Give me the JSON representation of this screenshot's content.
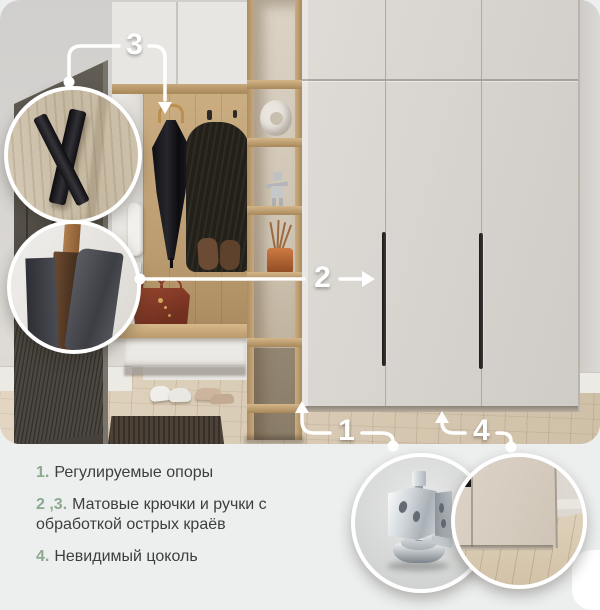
{
  "callouts": {
    "c1": {
      "label": "1"
    },
    "c2": {
      "label": "2"
    },
    "c3": {
      "label": "3"
    },
    "c4": {
      "label": "4"
    }
  },
  "legend": {
    "items": [
      {
        "num": "1.",
        "text": "Регулируемые опоры"
      },
      {
        "num": "2 ,3.",
        "text": "Матовые крючки и ручки с обработкой острых краёв"
      },
      {
        "num": "4.",
        "text": "Невидимый цоколь"
      }
    ]
  },
  "insets": {
    "hook": "matte-hook-closeup",
    "edge": "panel-edge-closeup",
    "foot": "adjustable-foot-closeup",
    "plinth": "hidden-plinth-closeup"
  },
  "colors": {
    "accent_green": "#8caa8e",
    "callout_white": "#ffffff",
    "background": "#edefef"
  }
}
